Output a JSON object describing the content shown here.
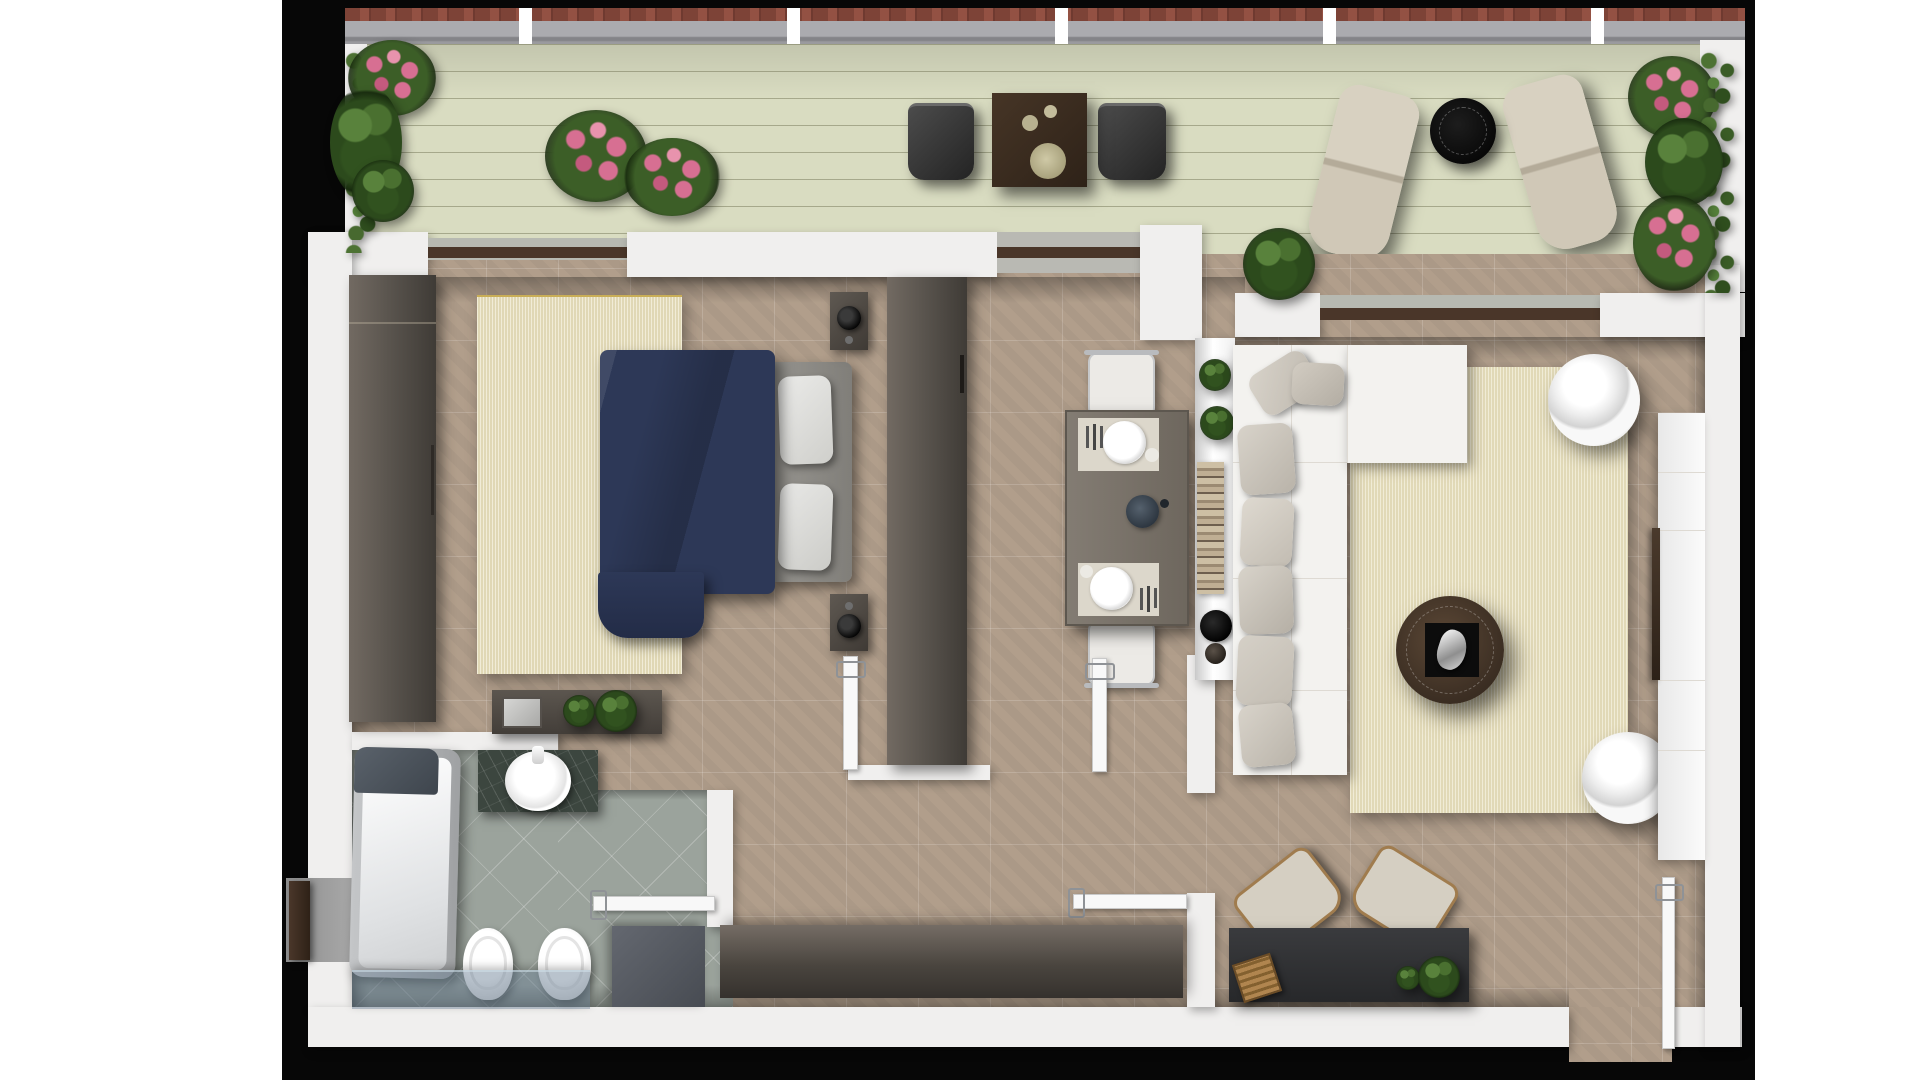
{
  "meta": {
    "kind": "architectural-floor-plan-render",
    "view": "top-down 2.5D render",
    "description": "One-bedroom apartment floor plan with wraparound terrace, bedroom, bathroom, kitchen-dining, hallway and living room on black backdrop",
    "visible_text": []
  },
  "palette": {
    "page-bg": "#ffffff",
    "plan-bg": "#070707",
    "deck": "#d9dcc1",
    "wall": "#f0efee",
    "tile": "#b19e8b",
    "bath-tile": "#9ba39c",
    "rug": "#ebe4c6",
    "navy": "#2d3857",
    "headboard": "#8d8b86",
    "sofa": "#f3f2ef",
    "pillow-a": "#d8d3ca",
    "pillow-b": "#c2bcb2",
    "table-gray": "#79726a",
    "placemat": "#dcd7cb",
    "chair-white": "#eceae6",
    "sideboard-a": "#756d65",
    "desk": "#303134",
    "coffee-table": "#46362b",
    "glass": "rgba(100,122,144,0.45)",
    "lounge": "#d5cfc2",
    "terrace-table": "#3a2c21",
    "marble": "#3c463f",
    "flower": "#d76f92",
    "sill-brown": "#4a3629",
    "slider-glass": "#b7b9b1"
  },
  "rooms": [
    {
      "name": "terrace",
      "features": [
        "wood decking",
        "railing",
        "planters with flowers"
      ]
    },
    {
      "name": "bedroom",
      "features": [
        "double bed",
        "wardrobe",
        "rug",
        "dresser",
        "nightstands"
      ]
    },
    {
      "name": "kitchen-dining",
      "features": [
        "tall unit",
        "dining table for two",
        "counter with decor"
      ]
    },
    {
      "name": "living-room",
      "features": [
        "L-shaped sofa",
        "rug",
        "coffee table",
        "swivel chairs",
        "tv unit",
        "desk"
      ]
    },
    {
      "name": "bathroom",
      "features": [
        "bathtub",
        "vessel sink vanity",
        "toilet",
        "bidet",
        "shower glass",
        "cabinet"
      ]
    },
    {
      "name": "hallway",
      "features": [
        "long sideboard",
        "entry door"
      ]
    }
  ],
  "furniture_labels": {
    "terrace": [
      "dining-table",
      "terrace-chair-left",
      "terrace-chair-right",
      "sun-lounger-1",
      "sun-lounger-2",
      "black-side-table"
    ],
    "bedroom": [
      "wardrobe",
      "bed-duvet",
      "headboard",
      "pillows",
      "nightstand-top",
      "nightstand-bottom",
      "table-lamp",
      "dresser",
      "dresser-plants"
    ],
    "kitchen": [
      "tall-cabinet",
      "dining-table",
      "chair-north",
      "chair-south",
      "placemats",
      "plates",
      "center-bowl",
      "counter",
      "counter-plants",
      "book-stack",
      "black-bowl",
      "vase"
    ],
    "living": [
      "sofa",
      "sofa-pillows",
      "area-rug",
      "coffee-table",
      "sculpture",
      "swivel-chair-north",
      "swivel-chair-south",
      "tv-unit",
      "tv-panel",
      "desk",
      "desk-chairs",
      "wood-crate",
      "desk-plants"
    ],
    "bathroom": [
      "bathtub",
      "vanity",
      "vessel-sink",
      "toilet",
      "bidet",
      "storage-cabinet",
      "shower-screen"
    ],
    "hallway": [
      "sideboard",
      "entry-door",
      "interior-doors"
    ]
  }
}
